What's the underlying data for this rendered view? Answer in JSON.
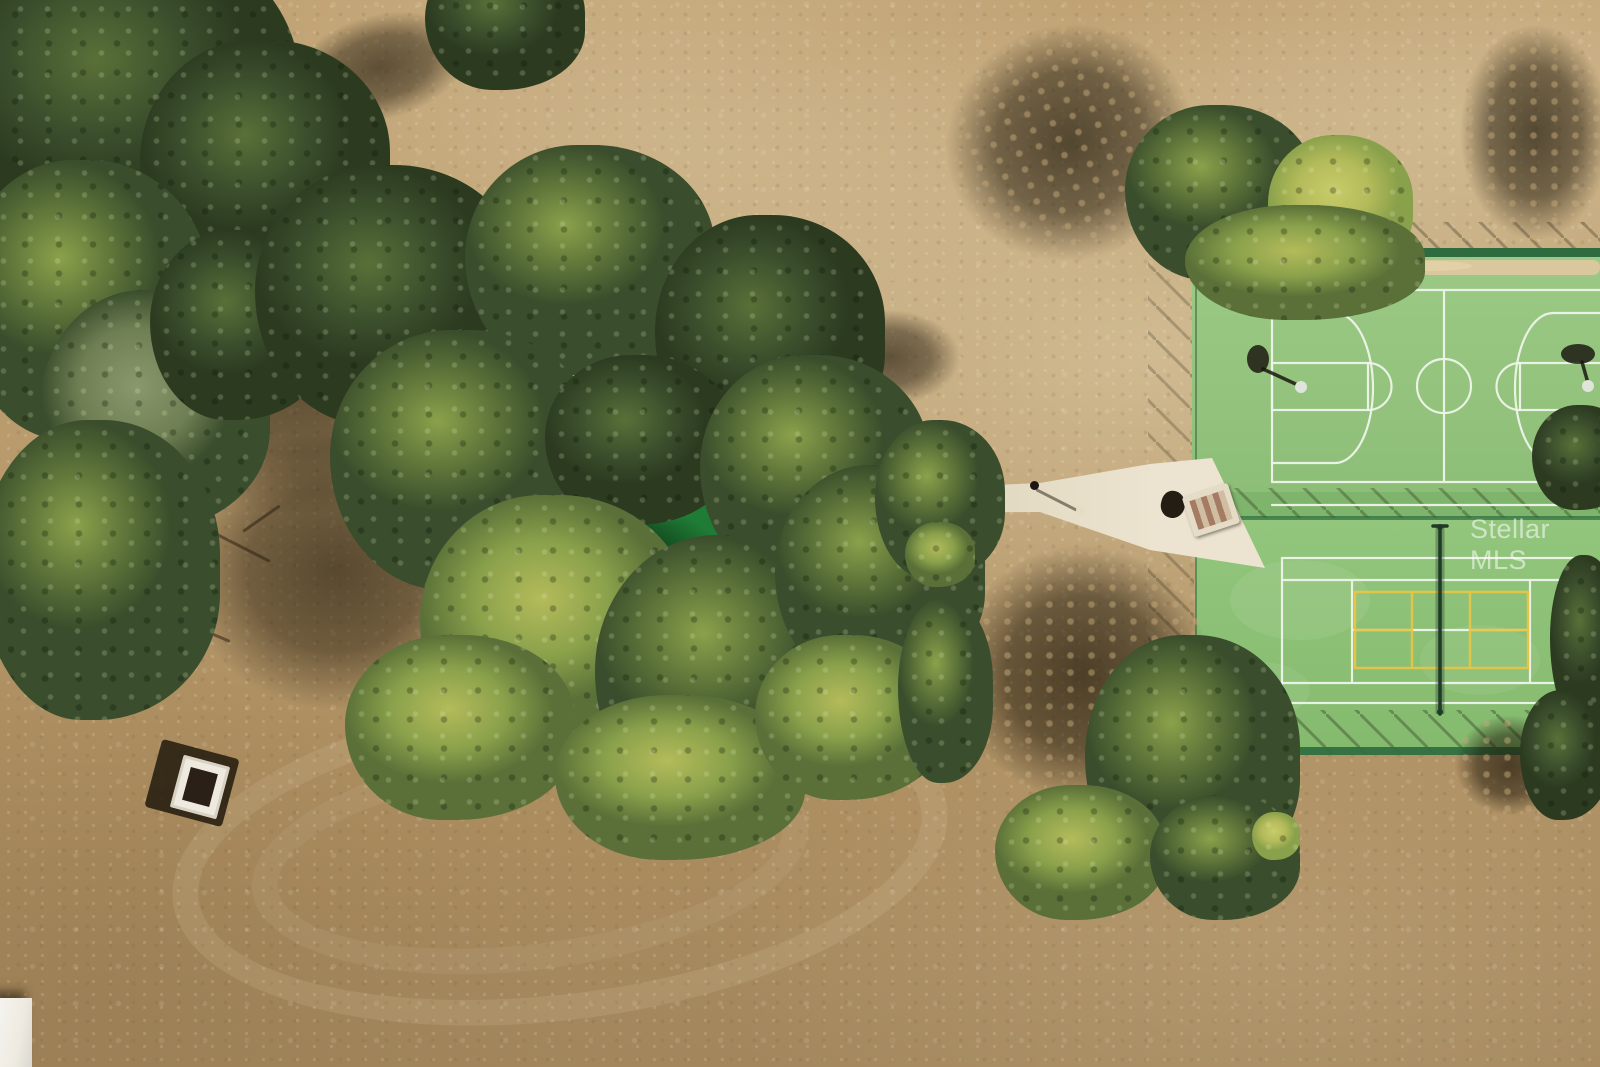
{
  "meta": {
    "type": "aerial-photograph",
    "description": "Overhead drone photo of a park: bare tan dirt field, large tree groves with long shadows, a concrete walking path leading to a fenced green basketball court and a tennis court with yellow pickleball lines, a small synthetic green pad among the trees, and a picnic table."
  },
  "watermark": {
    "text": "Stellar MLS"
  },
  "scene": {
    "ground": "bare tan dirt / dry turf field",
    "lighting": "low sun from southeast, long shadows cast to the northwest",
    "features": [
      {
        "name": "building-roof-corner",
        "label": "white roof edge under tree canopy, top-left corner"
      },
      {
        "name": "west-tree-grove",
        "label": "dense oak/cedar grove along left edge"
      },
      {
        "name": "central-tree-grove",
        "label": "large central cluster of oaks and pines with yellow-green fringe"
      },
      {
        "name": "putting-green-pad",
        "label": "kidney-shaped dark green synthetic pad shaded by trees"
      },
      {
        "name": "walking-path",
        "label": "concrete path widening toward the court entrance"
      },
      {
        "name": "basketball-court",
        "label": "light-green basketball court, white markings, two hoops"
      },
      {
        "name": "tennis-pickleball-court",
        "label": "green tennis court, white lines, yellow pickleball lines, net running north-south"
      },
      {
        "name": "court-fence-shadows",
        "label": "chain-link fence shadows hatched around courts"
      },
      {
        "name": "north-pines",
        "label": "pines north of courts with long shadows"
      },
      {
        "name": "southwest-pine",
        "label": "large pine southwest of tennis court with big shadow"
      },
      {
        "name": "picnic-table",
        "label": "picnic table on dirt, lower left"
      },
      {
        "name": "entrance-furniture",
        "label": "bench and table on concrete pad at court gate"
      },
      {
        "name": "corner-structure",
        "label": "small white structure at bottom-left corner"
      }
    ]
  },
  "colors": {
    "dirt_base": "#bb9c6e",
    "dirt_light": "#d2bb92",
    "dirt_pale": "#e3d3af",
    "dirt_dark": "#a3865c",
    "path_concrete": "#ddd3ba",
    "path_bright": "#ece4d0",
    "bb_court": "#9cca86",
    "bb_court_low": "#8dbe77",
    "tennis_court": "#93c67d",
    "tennis_court_low": "#84ba6e",
    "apron_green": "#7eb46b",
    "court_band": "#2e6b3e",
    "line_white": "#eef4ea",
    "pickleball_yellow": "#e8c544",
    "sand_strip": "#dcc89f",
    "tree_dark": "#3a4d2c",
    "tree_mid": "#5a7038",
    "tree_light": "#8aa14b",
    "tree_yellow": "#b4bb5a",
    "tree_gray": "#6f7f54",
    "tree_deep": "#2c3b20",
    "net_dark": "#1d3b27",
    "green_pad": "#1f7c36",
    "green_pad_light": "#2f9247",
    "roof_white": "#e2e2dd",
    "furniture_white": "#efeae0",
    "furniture_brown": "#9a6a52",
    "watermark_white": "#ffffff"
  }
}
